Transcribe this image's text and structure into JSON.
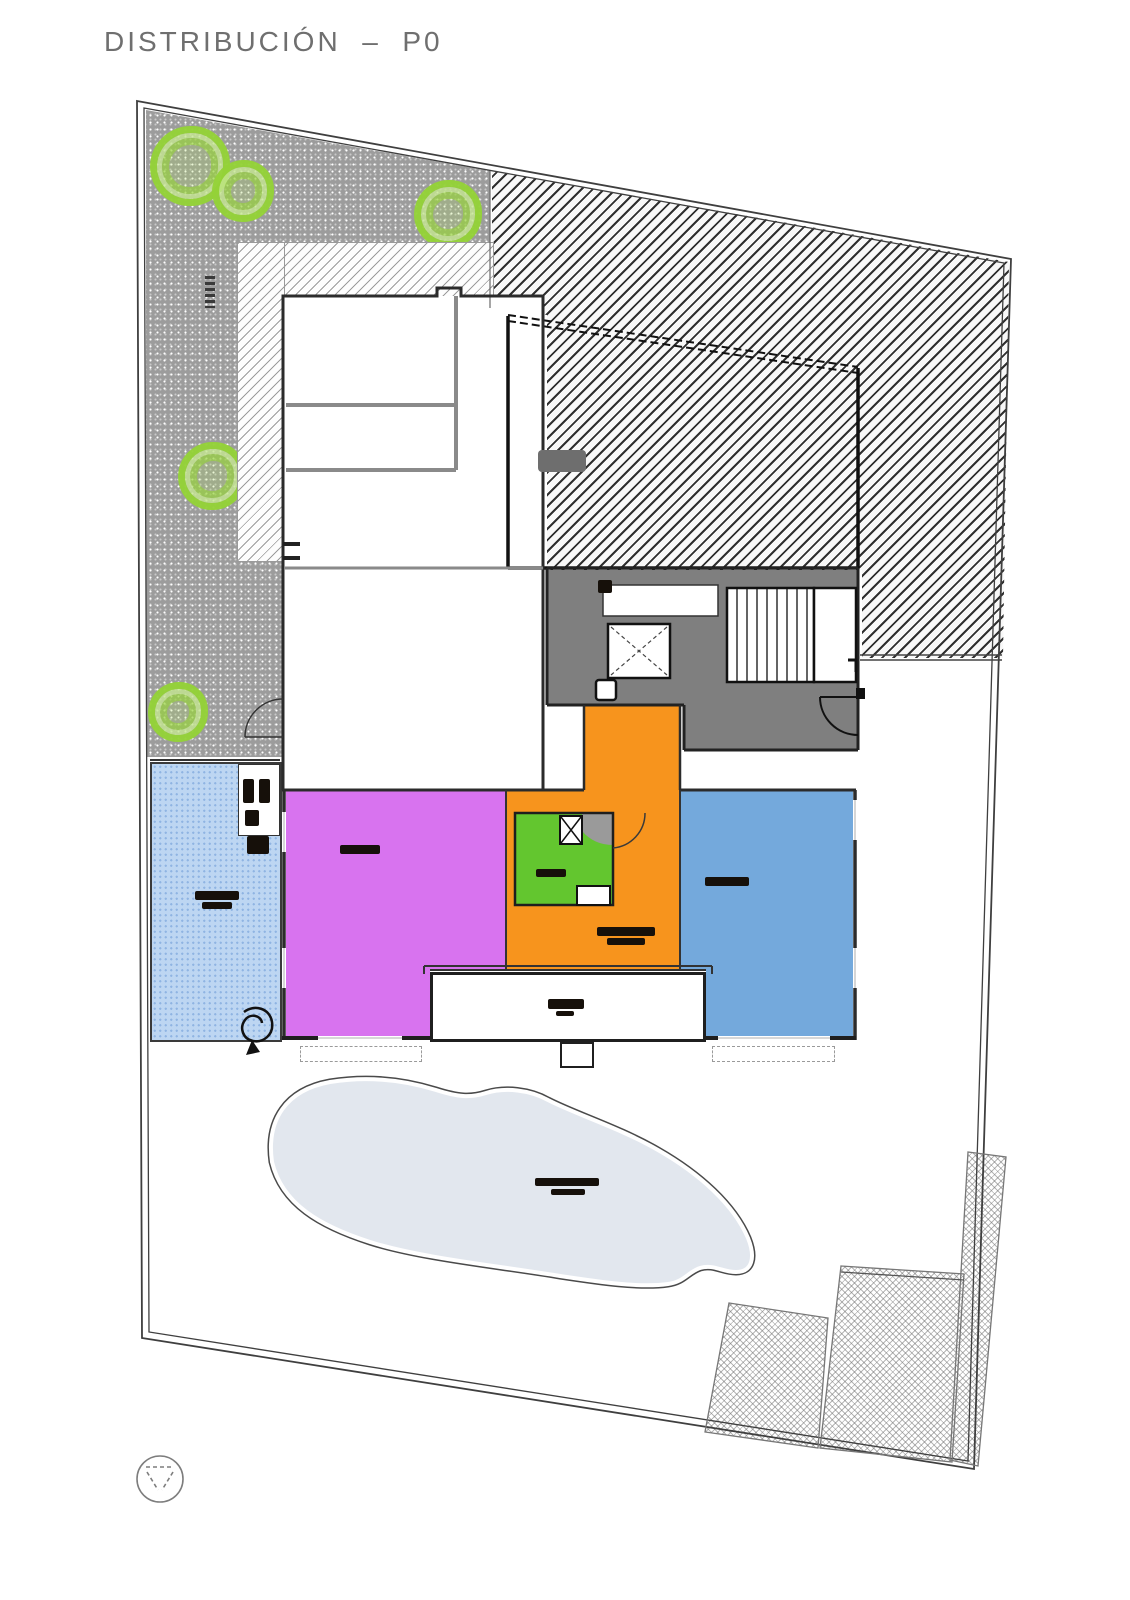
{
  "title": {
    "text": "DISTRIBUCIÓN  –  P0"
  },
  "colors": {
    "room_purple": "#d873ef",
    "room_orange": "#f7941d",
    "room_green": "#63c62f",
    "room_blue": "#74a9dc",
    "core_gray": "#7f7f7f",
    "terrace_gray": "#9c9c9c",
    "strip_blue": "#bdd6f2",
    "pool_fill": "#e2e7ee",
    "tree_green": "#94d237",
    "hatch_dark": "#2f2f2f",
    "title_gray": "#6f6f6f"
  },
  "rooms": [
    {
      "name": "room-purple",
      "color_key": "room_purple"
    },
    {
      "name": "room-orange",
      "color_key": "room_orange"
    },
    {
      "name": "room-green",
      "color_key": "room_green"
    },
    {
      "name": "room-blue",
      "color_key": "room_blue"
    },
    {
      "name": "terrace-garden",
      "color_key": "terrace_gray"
    },
    {
      "name": "side-terrace-strip",
      "color_key": "strip_blue"
    },
    {
      "name": "stair-core",
      "color_key": "core_gray"
    }
  ],
  "label_blobs": [
    {
      "name": "purple-room-label",
      "x": 340,
      "y": 845,
      "w": 40,
      "h": 9
    },
    {
      "name": "green-room-label",
      "x": 536,
      "y": 869,
      "w": 30,
      "h": 8
    },
    {
      "name": "orange-room-label-line1",
      "x": 597,
      "y": 927,
      "w": 58,
      "h": 9
    },
    {
      "name": "orange-room-label-line2",
      "x": 607,
      "y": 938,
      "w": 38,
      "h": 7
    },
    {
      "name": "blue-room-label",
      "x": 705,
      "y": 877,
      "w": 44,
      "h": 9
    },
    {
      "name": "side-strip-label-line1",
      "x": 195,
      "y": 891,
      "w": 44,
      "h": 9
    },
    {
      "name": "side-strip-label-line2",
      "x": 202,
      "y": 902,
      "w": 30,
      "h": 7
    },
    {
      "name": "porch-label-line1",
      "x": 548,
      "y": 999,
      "w": 36,
      "h": 10
    },
    {
      "name": "porch-label-line2",
      "x": 556,
      "y": 1011,
      "w": 18,
      "h": 5
    },
    {
      "name": "pool-label-line1",
      "x": 535,
      "y": 1178,
      "w": 64,
      "h": 8
    },
    {
      "name": "pool-label-line2",
      "x": 551,
      "y": 1189,
      "w": 34,
      "h": 6
    },
    {
      "name": "bath-fixture-glyph-a",
      "x": 243,
      "y": 779,
      "w": 11,
      "h": 24
    },
    {
      "name": "bath-fixture-glyph-b",
      "x": 259,
      "y": 779,
      "w": 11,
      "h": 24
    },
    {
      "name": "bath-fixture-glyph-c",
      "x": 245,
      "y": 810,
      "w": 14,
      "h": 16
    },
    {
      "name": "fixture-glyph-d",
      "x": 247,
      "y": 836,
      "w": 22,
      "h": 18
    },
    {
      "name": "vestibule-block",
      "x": 598,
      "y": 580,
      "w": 14,
      "h": 13
    },
    {
      "name": "neighbor-roof-patch",
      "x": 538,
      "y": 450,
      "w": 48,
      "h": 22,
      "color": "#6e6e6e",
      "r": 4
    },
    {
      "name": "terrace-vertical-note",
      "x": 205,
      "y": 276,
      "w": 10,
      "h": 32,
      "variant": "striped"
    }
  ],
  "trees": [
    {
      "x": 190,
      "y": 166,
      "r": 40
    },
    {
      "x": 243,
      "y": 191,
      "r": 31
    },
    {
      "x": 448,
      "y": 214,
      "r": 34
    },
    {
      "x": 212,
      "y": 476,
      "r": 34
    },
    {
      "x": 178,
      "y": 712,
      "r": 30
    }
  ]
}
